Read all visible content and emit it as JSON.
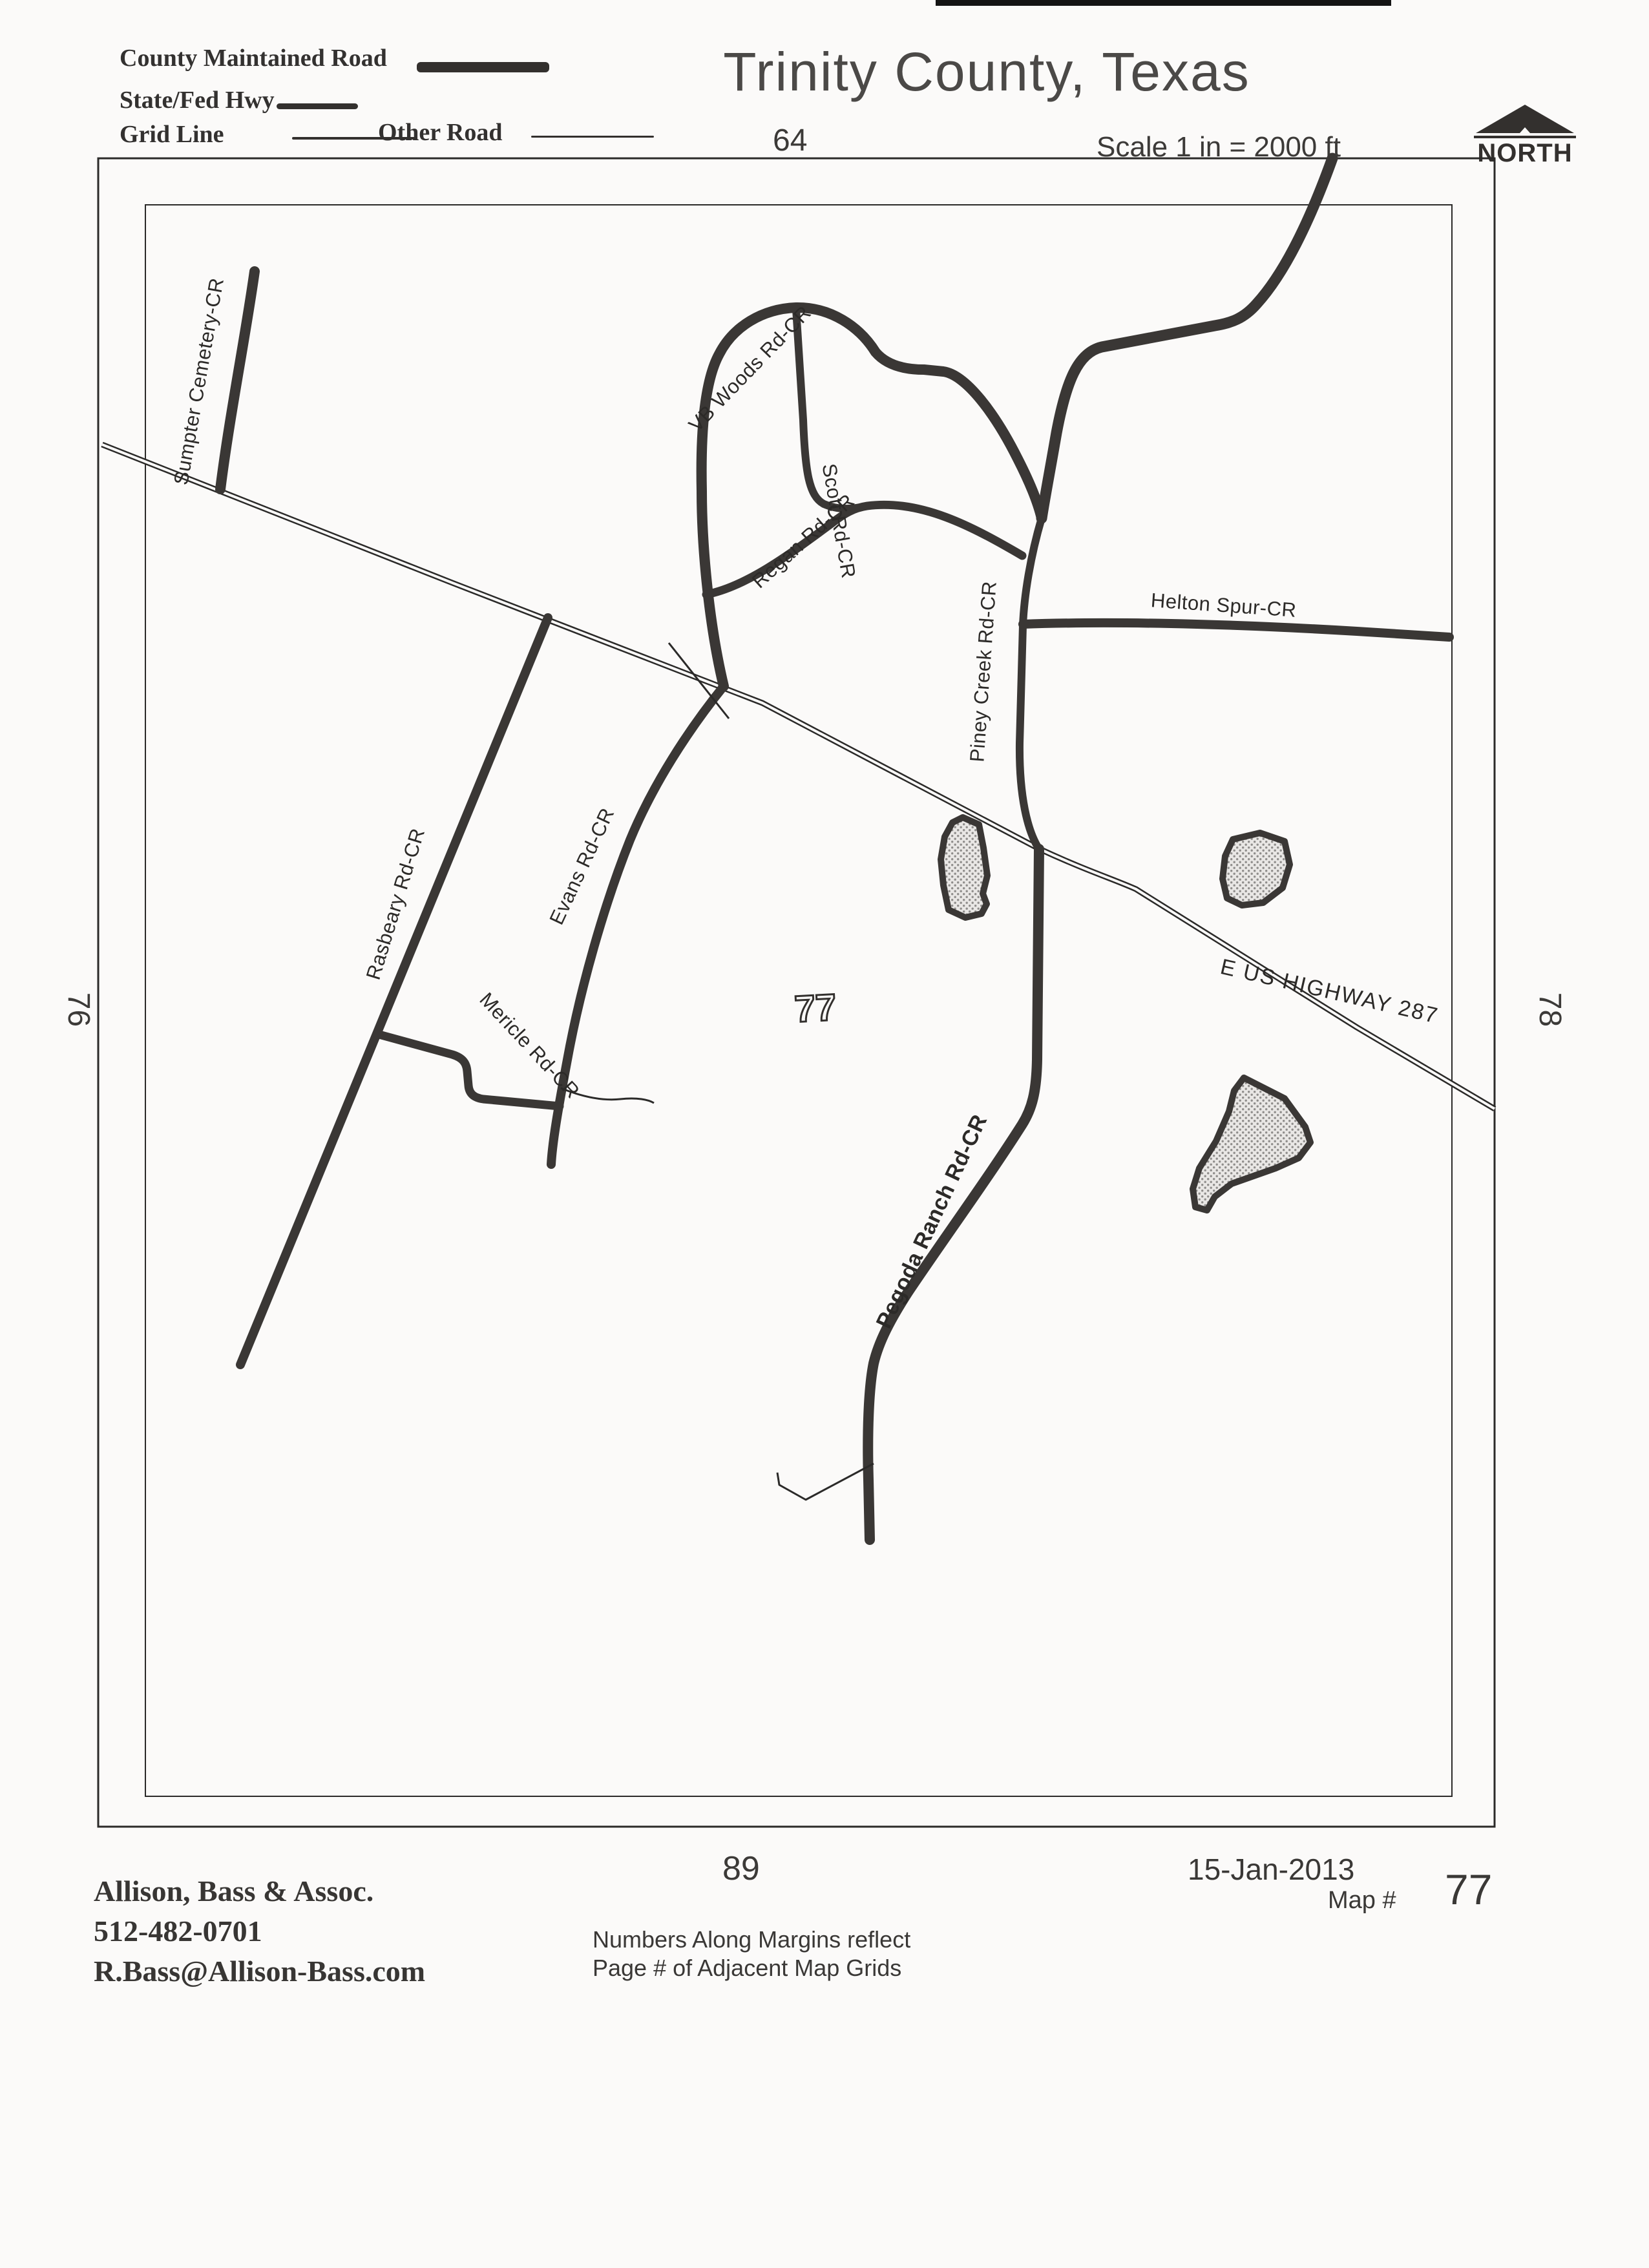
{
  "header": {
    "title": "Trinity County, Texas",
    "scale_label": "Scale 1 in = 2000 ft",
    "north_label": "NORTH",
    "legend": {
      "county_maintained_road": "County Maintained Road",
      "state_fed_hwy": "State/Fed Hwy",
      "grid_line": "Grid Line",
      "other_road": "Other Road"
    }
  },
  "margins": {
    "top": "64",
    "left": "76",
    "right": "78",
    "bottom": "89",
    "center_grid": "77"
  },
  "map": {
    "road_labels": {
      "sumpter": "Sumpter Cemetery-CR",
      "vb_woods": "VB Woods Rd-CR",
      "scott": "Scott Rd-CR",
      "regan": "Regan Rd-CR",
      "helton": "Helton Spur-CR",
      "piney": "Piney Creek Rd-CR",
      "evans": "Evans Rd-CR",
      "rasbeary": "Rasbeary Rd-CR",
      "mericle": "Mericle Rd-CR",
      "pegoda": "Pegoda Ranch Rd-CR",
      "hwy287": "E US HIGHWAY 287"
    }
  },
  "footer": {
    "company": "Allison, Bass & Assoc.",
    "phone": "512-482-0701",
    "email": "R.Bass@Allison-Bass.com",
    "note_line1": "Numbers Along Margins reflect",
    "note_line2": "Page # of Adjacent Map Grids",
    "date": "15-Jan-2013",
    "map_number_label": "Map #",
    "map_number": "77"
  },
  "colors": {
    "ink": "#33302e",
    "road": "#3a3735",
    "paper": "#fbfaf9"
  }
}
